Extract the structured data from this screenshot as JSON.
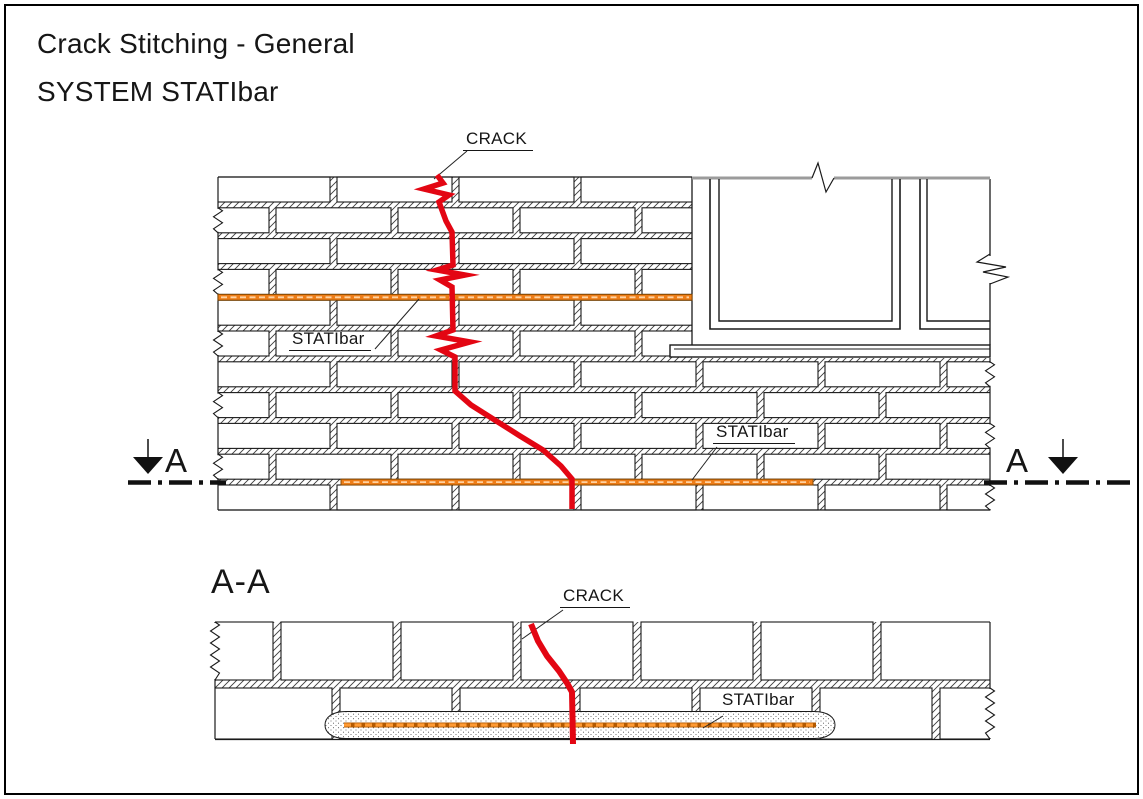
{
  "page": {
    "title_line1": "Crack Stitching - General",
    "title_line2": "SYSTEM STATIbar"
  },
  "labels": {
    "crack_upper": "CRACK",
    "statibar_upper_1": "STATIbar",
    "statibar_upper_2": "STATIbar",
    "section_letter_left": "A",
    "section_letter_right": "A",
    "section_title": "A-A",
    "crack_section": "CRACK",
    "statibar_section": "STATIbar"
  },
  "colors": {
    "crack_red": "#e30613",
    "statibar_fill": "#ee7d18",
    "statibar_border": "#8a4a00",
    "statibar_dash_light": "#ffd2a0",
    "statibar_section_base": "#b35900",
    "statibar_section_dash": "#ff9a33",
    "line_black": "#1a1a1a",
    "hatch_line": "#3c3c3c",
    "window_top_gray": "#9b9b9b",
    "stipple_dot": "#5a5a5a",
    "page_border": "#000000"
  }
}
